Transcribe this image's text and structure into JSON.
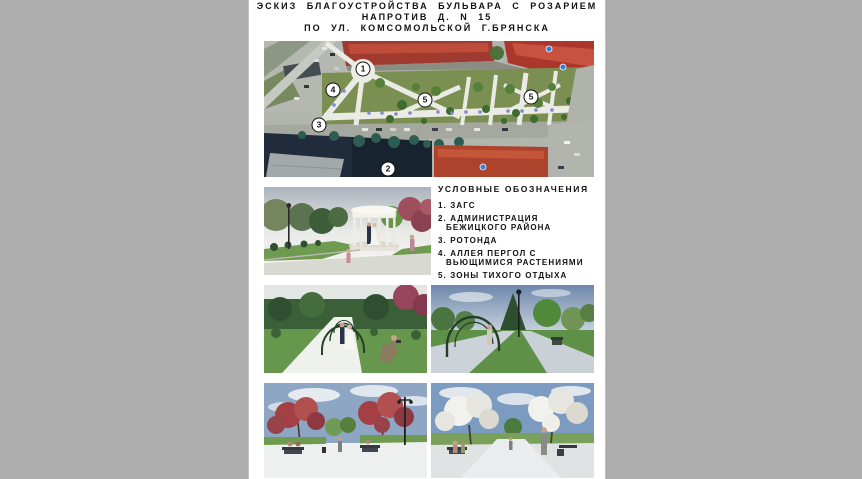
{
  "colors": {
    "page_background": "#adadad",
    "panel_background": "#ffffff",
    "marker_fill": "#ffffff",
    "marker_border": "#111111",
    "park_green": "#7c8f52",
    "roof_red": "#ab372c"
  },
  "title": {
    "line1": "ЭСКИЗ БЛАГОУСТРОЙСТВА БУЛЬВАРА С РОЗАРИЕМ",
    "line2": "НАПРОТИВ Д. N 15",
    "line3": "ПО УЛ. КОМСОМОЛЬСКОЙ Г.БРЯНСКА"
  },
  "site_plan": {
    "markers": [
      {
        "label": "1"
      },
      {
        "label": "2"
      },
      {
        "label": "3"
      },
      {
        "label": "4"
      },
      {
        "label": "5"
      },
      {
        "label": "5"
      }
    ]
  },
  "legend": {
    "title": "УСЛОВНЫЕ ОБОЗНАЧЕНИЯ",
    "items": [
      {
        "number": "1.",
        "label": "ЗАГС"
      },
      {
        "number": "2.",
        "label": "АДМИНИСТРАЦИЯ БЕЖИЦКОГО РАЙОНА"
      },
      {
        "number": "3.",
        "label": "РОТОНДА"
      },
      {
        "number": "4.",
        "label": "АЛЛЕЯ ПЕРГОЛ С ВЬЮЩИМИСЯ РАСТЕНИЯМИ"
      },
      {
        "number": "5.",
        "label": "ЗОНЫ ТИХОГО ОТДЫХА"
      }
    ]
  }
}
